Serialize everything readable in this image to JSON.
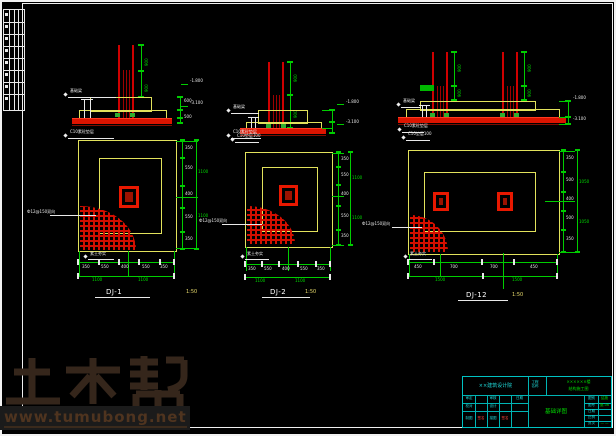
{
  "watermark": {
    "brand": "土木帮",
    "url": "www.tumubong.net"
  },
  "details": [
    {
      "title": "DJ-1",
      "scale": "1:50",
      "col_dims": [
        "900",
        "900"
      ],
      "sec_dims": [
        "600",
        "500"
      ],
      "elev_top": "-1.800",
      "elev_bot": "-3.100",
      "note_top": "基础梁",
      "note_bot": "C10素砼垫层",
      "hatch_note": "Ф12@150双向",
      "base_note": "素土夯实",
      "plan_note": "C10垫层100",
      "dims_right": [
        "350",
        "550",
        "400",
        "550",
        "350"
      ],
      "dims_bottom": [
        "350",
        "550",
        "400",
        "550",
        "350"
      ],
      "right_totals": [
        "1100",
        "1100"
      ],
      "bottom_totals": [
        "1100",
        "1100"
      ]
    },
    {
      "title": "DJ-2",
      "scale": "1:50",
      "col_dims": [
        "900",
        "900"
      ],
      "sec_dims": [
        "600",
        "500"
      ],
      "elev_top": "-1.800",
      "elev_bot": "-3.100",
      "note_top": "基础梁",
      "note_bot": "C10素砼垫层",
      "hatch_note": "Ф12@150双向",
      "base_note": "素土夯实",
      "plan_note": "C10垫层100",
      "dims_right": [
        "350",
        "550",
        "400",
        "550",
        "350"
      ],
      "dims_bottom": [
        "350",
        "550",
        "400",
        "550",
        "350"
      ],
      "right_totals": [
        "1100",
        "1100"
      ],
      "bottom_totals": [
        "1100",
        "1100"
      ]
    },
    {
      "title": "DJ-12",
      "scale": "1:50",
      "col_dims": [
        "900",
        "900"
      ],
      "sec_dims": [
        "600",
        "500"
      ],
      "elev_top": "-1.800",
      "elev_bot": "-3.100",
      "note_top": "基础梁",
      "note_bot": "C10素砼垫层",
      "hatch_note": "Ф12@150双向",
      "base_note": "素土夯实",
      "plan_note": "C10垫层100",
      "dims_right": [
        "350",
        "500",
        "400",
        "500",
        "350"
      ],
      "dims_bottom": [
        "450",
        "700",
        "700",
        "450"
      ],
      "right_totals": [
        "1050",
        "1050"
      ],
      "bottom_totals": [
        "1500",
        "1500"
      ]
    }
  ],
  "title_block": {
    "firm": "××建筑设计院",
    "name_label": "工程名称",
    "project_line1": "××××××楼",
    "project_line2": "结构施工图",
    "rows": [
      [
        "审定",
        "",
        "审核",
        "",
        "日期"
      ],
      [
        "校对",
        "",
        "设计",
        "",
        ""
      ],
      [
        "制图",
        "签名",
        "描图",
        "签名",
        ""
      ]
    ],
    "drawing_title": "基础详图",
    "mini": [
      [
        "图别",
        "结施"
      ],
      [
        "图号",
        "施-06"
      ],
      [
        "日期",
        ""
      ],
      [
        "比例",
        ""
      ],
      [
        "页次",
        "— —"
      ]
    ]
  }
}
